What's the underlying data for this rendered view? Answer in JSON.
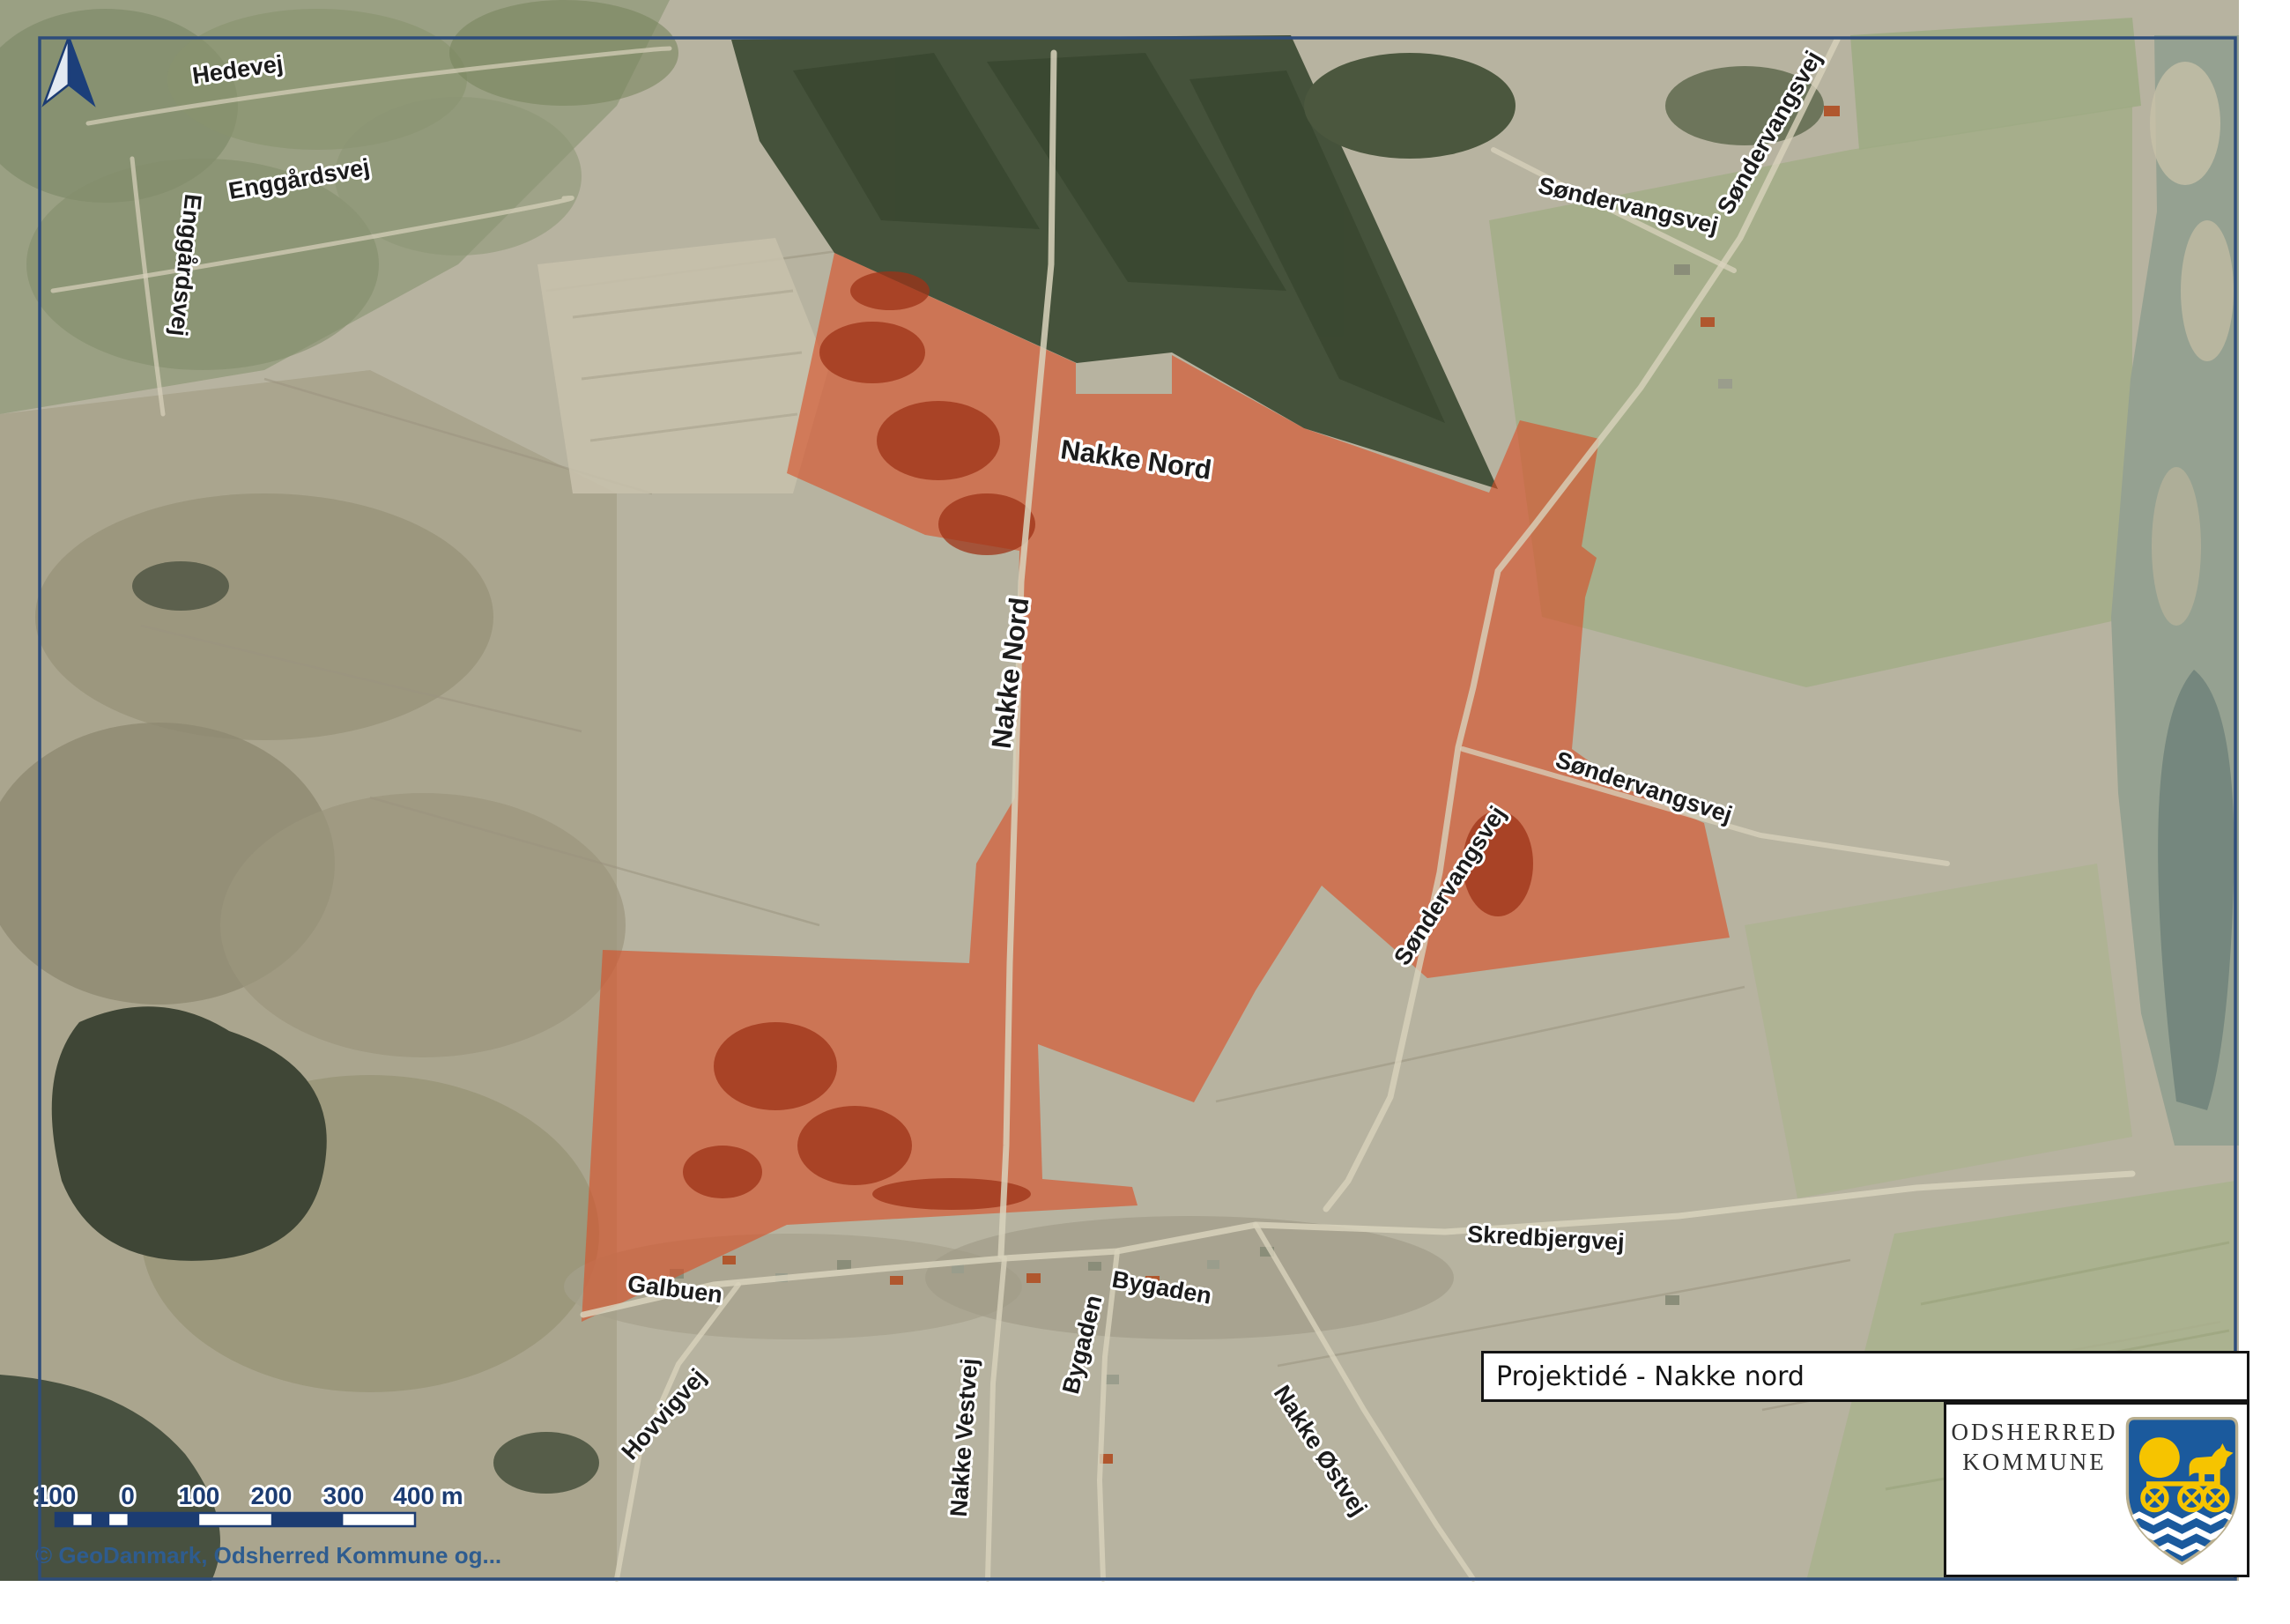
{
  "title_box": {
    "title": "Projektidé - Nakke nord"
  },
  "logo": {
    "line1": "ODSHERRED",
    "line2": "KOMMUNE"
  },
  "attribution": "© GeoDanmark, Odsherred Kommune og...",
  "scalebar": {
    "ticks": [
      "100",
      "0",
      "100",
      "200",
      "300",
      "400 m"
    ]
  },
  "labels": [
    {
      "id": "hedevej",
      "text": "Hedevej"
    },
    {
      "id": "enggardsvej-h",
      "text": "Enggårdsvej"
    },
    {
      "id": "enggardsvej-v",
      "text": "Enggårdsvej"
    },
    {
      "id": "nakke-nord-area",
      "text": "Nakke Nord"
    },
    {
      "id": "nakke-nord-road",
      "text": "Nakke Nord"
    },
    {
      "id": "sondervangsvej-ne",
      "text": "Søndervangsvej"
    },
    {
      "id": "sondervangsvej-up",
      "text": "Søndervangsvej"
    },
    {
      "id": "sondervangsvej-mid",
      "text": "Søndervangsvej"
    },
    {
      "id": "sondervangsvej-st",
      "text": "Søndervangsvej"
    },
    {
      "id": "skredbjergvej",
      "text": "Skredbjergvej"
    },
    {
      "id": "galbuen",
      "text": "Galbuen"
    },
    {
      "id": "hovvigvej",
      "text": "Hovvigvej"
    },
    {
      "id": "nakke-vestvej",
      "text": "Nakke Vestvej"
    },
    {
      "id": "bygaden-h",
      "text": "Bygaden"
    },
    {
      "id": "bygaden-v",
      "text": "Bygaden"
    },
    {
      "id": "nakke-ostvej",
      "text": "Nakke Østvej"
    }
  ],
  "colors": {
    "project_area_orange": "#D94F26",
    "map_border_navy": "#2E4D7B",
    "scalebar_navy": "#1C3C72",
    "attribution_blue": "#2E5C8F",
    "shield_blue": "#1B5A9D",
    "shield_yellow": "#F6C400"
  }
}
